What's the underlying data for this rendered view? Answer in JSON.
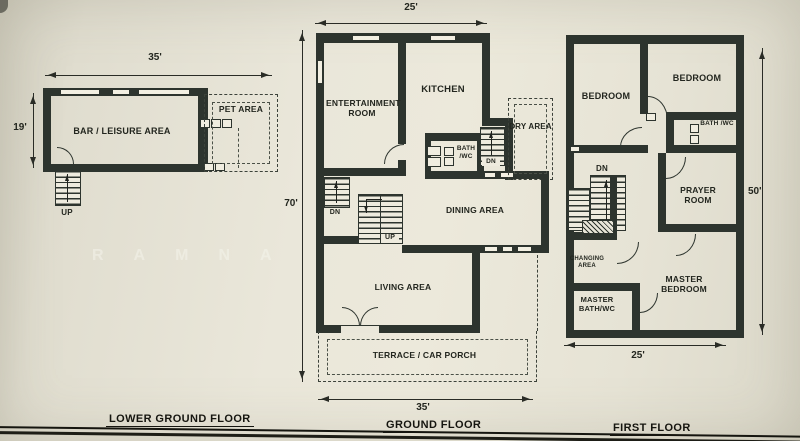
{
  "meta": {
    "wall_color": "#2d342e",
    "paper_color": "#eae7da",
    "edge_color": "#15150f"
  },
  "watermark": {
    "text": "RAMNA"
  },
  "plans": {
    "lower_ground": {
      "title": "LOWER GROUND FLOOR",
      "dim_top": "35'",
      "dim_left": "19'",
      "room_bar": "BAR / LEISURE AREA",
      "room_pet": "PET AREA",
      "stair_up": "UP"
    },
    "ground": {
      "title": "GROUND FLOOR",
      "dim_top": "25'",
      "dim_left": "70'",
      "dim_bottom": "35'",
      "room_entertainment": "ENTERTAINMENT ROOM",
      "room_kitchen": "KITCHEN",
      "room_bath": "BATH /WC",
      "room_dry": "DRY AREA",
      "room_dining": "DINING AREA",
      "room_living": "LIVING AREA",
      "room_terrace": "TERRACE / CAR PORCH",
      "stair_dn_service": "DN",
      "stair_dn_hall": "DN",
      "stair_up": "UP"
    },
    "first": {
      "title": "FIRST FLOOR",
      "dim_right": "50'",
      "dim_bottom": "25'",
      "room_bedroom_left": "BEDROOM",
      "room_bedroom_right": "BEDROOM",
      "room_bath": "BATH /WC",
      "room_prayer": "PRAYER ROOM",
      "room_changing": "CHANGING AREA",
      "room_master_bath": "MASTER BATH/WC",
      "room_master_bedroom": "MASTER BEDROOM",
      "stair_dn": "DN"
    }
  }
}
